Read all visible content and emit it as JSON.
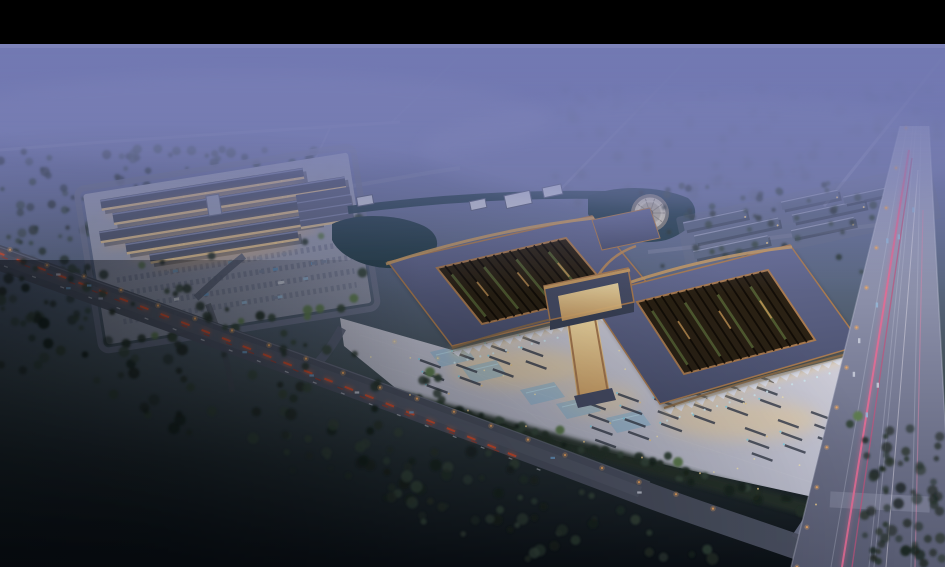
{
  "meta": {
    "title": "Aerial night rendering",
    "description": "Dusk aerial rendering of a large traditional-eave market/terminal complex: two slate-roofed pavilions with timber-lattice roof openings joined by a glowing gate corridor, a vast illuminated plaza with bus bays and reflecting pools, a secondary warehouse complex with parking at left, ponds with a circular fountain, rows of outbuildings, misty purple fields above, a diagonal highway with red tail-light trails and a wide vertical road with pink light trails at right, dark forests below."
  },
  "palette": {
    "letterbox": "#000000",
    "sky-top": "#7077ae",
    "sky-upper": "#6b739c",
    "sky-mid": "#5a6780",
    "land-mid": "#44515a",
    "land-dark": "#242e33",
    "land-deep": "#0b1016",
    "mist": "#7279b2",
    "mist-edge": "#8e93c4",
    "tree-far": "#4e5a60",
    "tree-mid": "#35453a",
    "tree-dark": "#26322a",
    "tree-deep": "#1a241e",
    "tree-light": "#5d7a50",
    "road-light": "#a8abc4",
    "road-mid": "#8a8ea8",
    "road-dark": "#4d5263",
    "road-faint": "#a2a6c4",
    "lane-line": "#c6c9da",
    "trail-red": "#e0502e",
    "trail-red-glow": "#ff6a3c",
    "trail-red-dim": "#b03a28",
    "trail-pink": "#e26b94",
    "trail-pink-dim": "#c2517a",
    "trail-pink-soft": "#d886a8",
    "headlight": "#d8dce8",
    "lamp": "#f0a860",
    "lamp-warm": "#e8c88a",
    "roof-slate": "#4b516f",
    "roof-slate-light": "#6a7098",
    "roof-gray": "#5d6880",
    "copper": "#a87a50",
    "copper-bright": "#c59a62",
    "timber-dark": "#2a2114",
    "timber-rib": "#100b06",
    "timber-green": "#5a6838",
    "glow-warm": "#f2cf8e",
    "glow-deep": "#cf9f62",
    "canopy": "#dde0ec",
    "column-teal": "#cfe8f0",
    "plaza-light": "#d6d3da",
    "plaza-mid": "#c2c3d2",
    "plaza-dark": "#a6a9bb",
    "bay-dark": "#3c4250",
    "pool-blue": "#7fb3d4",
    "pool-spark": "#7fd0e8",
    "water": "#27404c",
    "fountain-light": "#cdc6b4",
    "fountain-mid": "#b5ae9c",
    "fountain-dark": "#8a8478",
    "building-white": "#c9ccd9",
    "building-body": "#4e5569",
    "building-ridge": "#7c83a4",
    "facade-lit": "#f0cf96",
    "under-glow": "#e8b06a",
    "pad": "#989db2",
    "car-blue": "#6d9cc8",
    "car-pale": "#93b4d4",
    "car-light": "#c6cbd8",
    "plaza-dot": "#f2e4b6"
  },
  "scene": {
    "regions": [
      {
        "name": "letterbox-top",
        "desc": "black bar across top of frame"
      },
      {
        "name": "misty-fields",
        "desc": "purple haze over distant fields, faint diagonal roads"
      },
      {
        "name": "left-complex",
        "desc": "warehouse cluster with lit facades and striped parking lot"
      },
      {
        "name": "main-pavilion-left",
        "desc": "slate roof with timber lattice opening, copper trim"
      },
      {
        "name": "main-pavilion-right",
        "desc": "slate roof with timber lattice opening, copper trim"
      },
      {
        "name": "gate-corridor",
        "desc": "glowing entrance gate and corridor between pavilions"
      },
      {
        "name": "plaza",
        "desc": "illuminated forecourt with bus bays, pools and point lights"
      },
      {
        "name": "pond-and-fountain",
        "desc": "dark ponds and circular tiered fountain"
      },
      {
        "name": "row-buildings",
        "desc": "rows of small gray-roofed outbuildings"
      },
      {
        "name": "highway",
        "desc": "diagonal artery with red tail-light trails"
      },
      {
        "name": "vertical-road",
        "desc": "wide avenue at right with pink light trails"
      },
      {
        "name": "forests",
        "desc": "dark tree masses and night fields"
      }
    ]
  }
}
